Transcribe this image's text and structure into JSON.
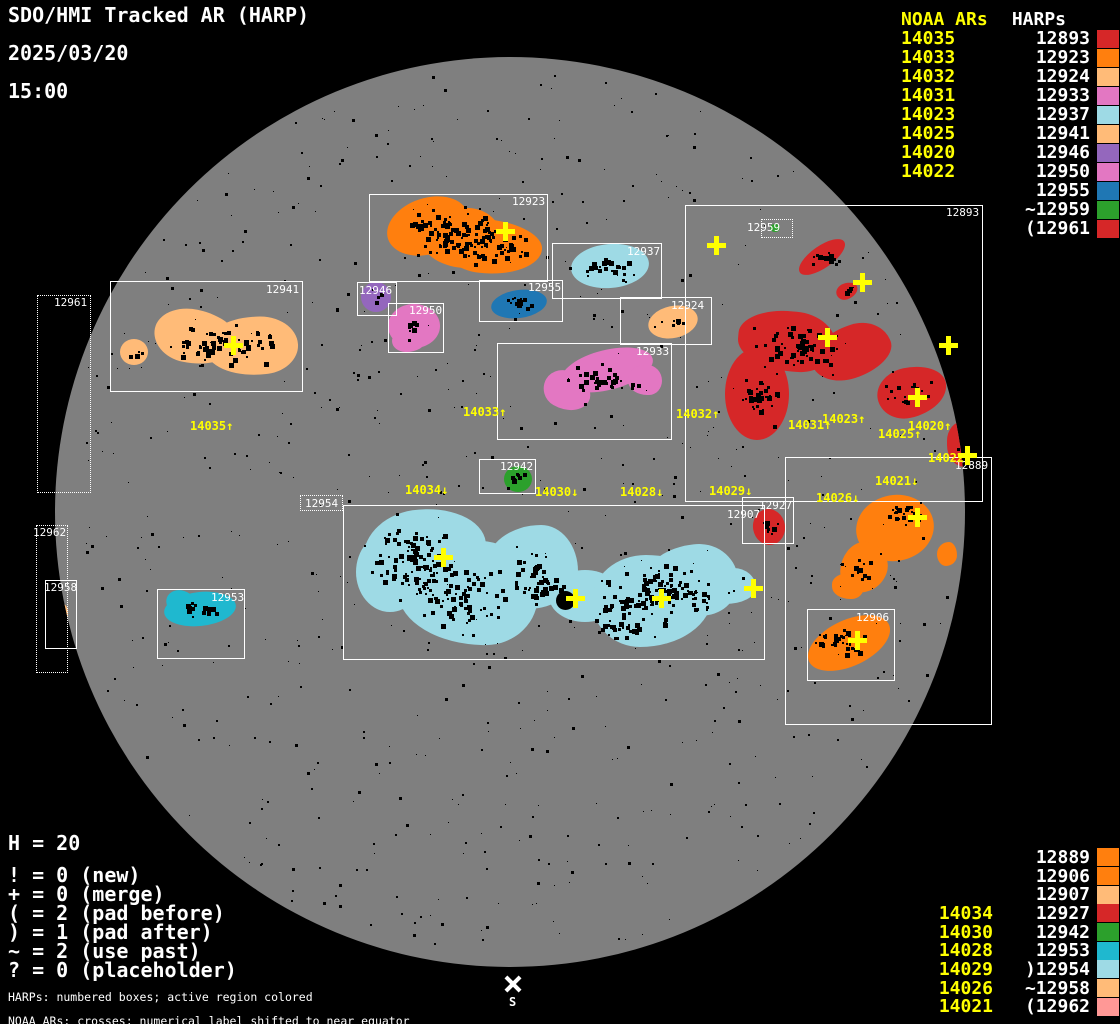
{
  "title": {
    "line1": "SDO/HMI Tracked AR (HARP)",
    "line2": "2025/03/20",
    "line3": "15:00"
  },
  "palette": {
    "background": "#000000",
    "disk_gray": "#7f7f7f",
    "annotation_yellow": "#ffff00",
    "annotation_white": "#ffffff"
  },
  "legend_top_right": {
    "noaa_header": "NOAA ARs",
    "harp_header": "HARPs",
    "rows": [
      {
        "noaa": "14035",
        "harp": "12893",
        "color": "#d62728"
      },
      {
        "noaa": "14033",
        "harp": "12923",
        "color": "#ff7f0e"
      },
      {
        "noaa": "14032",
        "harp": "12924",
        "color": "#ffbb78"
      },
      {
        "noaa": "14031",
        "harp": "12933",
        "color": "#e377c2"
      },
      {
        "noaa": "14023",
        "harp": "12937",
        "color": "#9edae5"
      },
      {
        "noaa": "14025",
        "harp": "12941",
        "color": "#ffbb78"
      },
      {
        "noaa": "14020",
        "harp": "12946",
        "color": "#9467bd"
      },
      {
        "noaa": "14022",
        "harp": "12950",
        "color": "#e377c2"
      },
      {
        "noaa": "",
        "harp": "12955",
        "color": "#1f77b4"
      },
      {
        "noaa": "",
        "harp": "~12959",
        "color": "#2ca02c"
      },
      {
        "noaa": "",
        "harp": "(12961",
        "color": "#d62728"
      }
    ]
  },
  "legend_bottom_right": {
    "rows": [
      {
        "noaa": "",
        "harp": "12889",
        "color": "#ff7f0e"
      },
      {
        "noaa": "",
        "harp": "12906",
        "color": "#ff7f0e"
      },
      {
        "noaa": "",
        "harp": "12907",
        "color": "#ffbb78"
      },
      {
        "noaa": "14034",
        "harp": "12927",
        "color": "#d62728"
      },
      {
        "noaa": "14030",
        "harp": "12942",
        "color": "#2ca02c"
      },
      {
        "noaa": "14028",
        "harp": "12953",
        "color": "#1fb8cf"
      },
      {
        "noaa": "14029",
        "harp": ")12954",
        "color": "#9edae5"
      },
      {
        "noaa": "14026",
        "harp": "~12958",
        "color": "#ffbb78"
      },
      {
        "noaa": "14021",
        "harp": "(12962",
        "color": "#ff9896"
      }
    ]
  },
  "stats": {
    "harp_count": "H = 20",
    "lines": [
      "! = 0 (new)",
      "+ = 0 (merge)",
      "( = 2 (pad before)",
      ") = 1 (pad after)",
      "~ = 2 (use past)",
      "? = 0 (placeholder)"
    ]
  },
  "footnotes": [
    "HARPs: numbered boxes; active region colored",
    "NOAA ARs: crosses; numerical label shifted to near equator"
  ],
  "south_marker": {
    "label": "S",
    "x": 513,
    "y": 984
  },
  "chart_data": {
    "type": "scatter",
    "title": "SDO/HMI Tracked AR (HARP)",
    "date": "2025/03/20",
    "time": "15:00",
    "harp_count": 20,
    "region_colors": {
      "12893": "#d62728",
      "12923": "#ff7f0e",
      "12924": "#ffbb78",
      "12933": "#e377c2",
      "12937": "#9edae5",
      "12941": "#ffbb78",
      "12946": "#9467bd",
      "12950": "#e377c2",
      "12955": "#1f77b4",
      "12959": "#2ca02c",
      "12961": "#d62728",
      "12889": "#ff7f0e",
      "12906": "#ff7f0e",
      "12907": "#ffbb78",
      "12927": "#d62728",
      "12942": "#2ca02c",
      "12953": "#1fb8cf",
      "12954": "#9edae5",
      "12958": "#ffbb78",
      "12962": "#ff9896"
    },
    "harp_boxes": [
      {
        "id": "12923",
        "label": "12923",
        "x": 369,
        "y": 194,
        "w": 179,
        "h": 88,
        "border": "solid",
        "lx": 512,
        "ly": 196
      },
      {
        "id": "12937",
        "label": "12937",
        "x": 552,
        "y": 243,
        "w": 110,
        "h": 56,
        "border": "solid",
        "lx": 627,
        "ly": 246
      },
      {
        "id": "12955",
        "label": "12955",
        "x": 479,
        "y": 280,
        "w": 84,
        "h": 42,
        "border": "solid",
        "lx": 528,
        "ly": 282
      },
      {
        "id": "12946",
        "label": "12946",
        "x": 357,
        "y": 282,
        "w": 40,
        "h": 34,
        "border": "solid",
        "lx": 359,
        "ly": 285
      },
      {
        "id": "12950",
        "label": "12950",
        "x": 388,
        "y": 303,
        "w": 56,
        "h": 50,
        "border": "solid",
        "lx": 409,
        "ly": 305
      },
      {
        "id": "12924",
        "label": "12924",
        "x": 620,
        "y": 297,
        "w": 92,
        "h": 48,
        "border": "solid",
        "lx": 671,
        "ly": 300
      },
      {
        "id": "12933",
        "label": "12933",
        "x": 497,
        "y": 343,
        "w": 175,
        "h": 97,
        "border": "solid",
        "lx": 636,
        "ly": 346
      },
      {
        "id": "12893",
        "label": "12893",
        "x": 685,
        "y": 205,
        "w": 298,
        "h": 297,
        "border": "solid",
        "lx": 946,
        "ly": 207
      },
      {
        "id": "12959",
        "label": "12959",
        "x": 761,
        "y": 219,
        "w": 32,
        "h": 19,
        "border": "dotted",
        "lx": 747,
        "ly": 222
      },
      {
        "id": "12961",
        "label": "12961",
        "x": 37,
        "y": 295,
        "w": 54,
        "h": 198,
        "border": "dotted",
        "lx": 54,
        "ly": 297
      },
      {
        "id": "12941",
        "label": "12941",
        "x": 110,
        "y": 281,
        "w": 193,
        "h": 111,
        "border": "solid",
        "lx": 266,
        "ly": 284
      },
      {
        "id": "12962",
        "label": "12962",
        "x": 36,
        "y": 525,
        "w": 32,
        "h": 148,
        "border": "dotted",
        "lx": 33,
        "ly": 527
      },
      {
        "id": "12958",
        "label": "12958",
        "x": 45,
        "y": 580,
        "w": 32,
        "h": 69,
        "border": "solid",
        "lx": 44,
        "ly": 582
      },
      {
        "id": "12953",
        "label": "12953",
        "x": 157,
        "y": 589,
        "w": 88,
        "h": 70,
        "border": "solid",
        "lx": 211,
        "ly": 592
      },
      {
        "id": "12942",
        "label": "12942",
        "x": 479,
        "y": 459,
        "w": 57,
        "h": 35,
        "border": "solid",
        "lx": 500,
        "ly": 461
      },
      {
        "id": "12954",
        "label": "12954",
        "x": 343,
        "y": 505,
        "w": 422,
        "h": 155,
        "border": "solid",
        "lx": 305,
        "ly": 498,
        "label_frame": true
      },
      {
        "id": "12927",
        "label": "12927",
        "x": 742,
        "y": 497,
        "w": 52,
        "h": 47,
        "border": "solid",
        "lx": 759,
        "ly": 500
      },
      {
        "id": "12907",
        "label": "12907",
        "x": 0,
        "y": 0,
        "w": 0,
        "h": 0,
        "border": "solid",
        "lx": 727,
        "ly": 509
      },
      {
        "id": "12889",
        "label": "12889",
        "x": 785,
        "y": 457,
        "w": 207,
        "h": 268,
        "border": "solid",
        "lx": 955,
        "ly": 460
      },
      {
        "id": "12906",
        "label": "12906",
        "x": 807,
        "y": 609,
        "w": 88,
        "h": 72,
        "border": "solid",
        "lx": 856,
        "ly": 612
      }
    ],
    "noaa_labels": [
      {
        "text": "14035↑",
        "x": 190,
        "y": 420
      },
      {
        "text": "14033↑",
        "x": 463,
        "y": 406
      },
      {
        "text": "14032↑",
        "x": 676,
        "y": 408
      },
      {
        "text": "14031↑",
        "x": 788,
        "y": 419
      },
      {
        "text": "14023↑",
        "x": 822,
        "y": 413
      },
      {
        "text": "14020↑",
        "x": 908,
        "y": 420
      },
      {
        "text": "14025↑",
        "x": 878,
        "y": 428
      },
      {
        "text": "14022↑",
        "x": 928,
        "y": 452
      },
      {
        "text": "14021↓",
        "x": 875,
        "y": 475
      },
      {
        "text": "14026↓",
        "x": 816,
        "y": 492
      },
      {
        "text": "14034↓",
        "x": 405,
        "y": 484
      },
      {
        "text": "14030↓",
        "x": 535,
        "y": 486
      },
      {
        "text": "14028↓",
        "x": 620,
        "y": 486
      },
      {
        "text": "14029↓",
        "x": 709,
        "y": 485
      }
    ],
    "noaa_crosses": [
      {
        "x": 505,
        "y": 231
      },
      {
        "x": 716,
        "y": 245
      },
      {
        "x": 862,
        "y": 282
      },
      {
        "x": 827,
        "y": 337
      },
      {
        "x": 948,
        "y": 345
      },
      {
        "x": 917,
        "y": 397
      },
      {
        "x": 967,
        "y": 455
      },
      {
        "x": 233,
        "y": 345
      },
      {
        "x": 443,
        "y": 557
      },
      {
        "x": 575,
        "y": 598
      },
      {
        "x": 661,
        "y": 598
      },
      {
        "x": 753,
        "y": 588
      },
      {
        "x": 917,
        "y": 517
      },
      {
        "x": 857,
        "y": 640
      }
    ]
  }
}
